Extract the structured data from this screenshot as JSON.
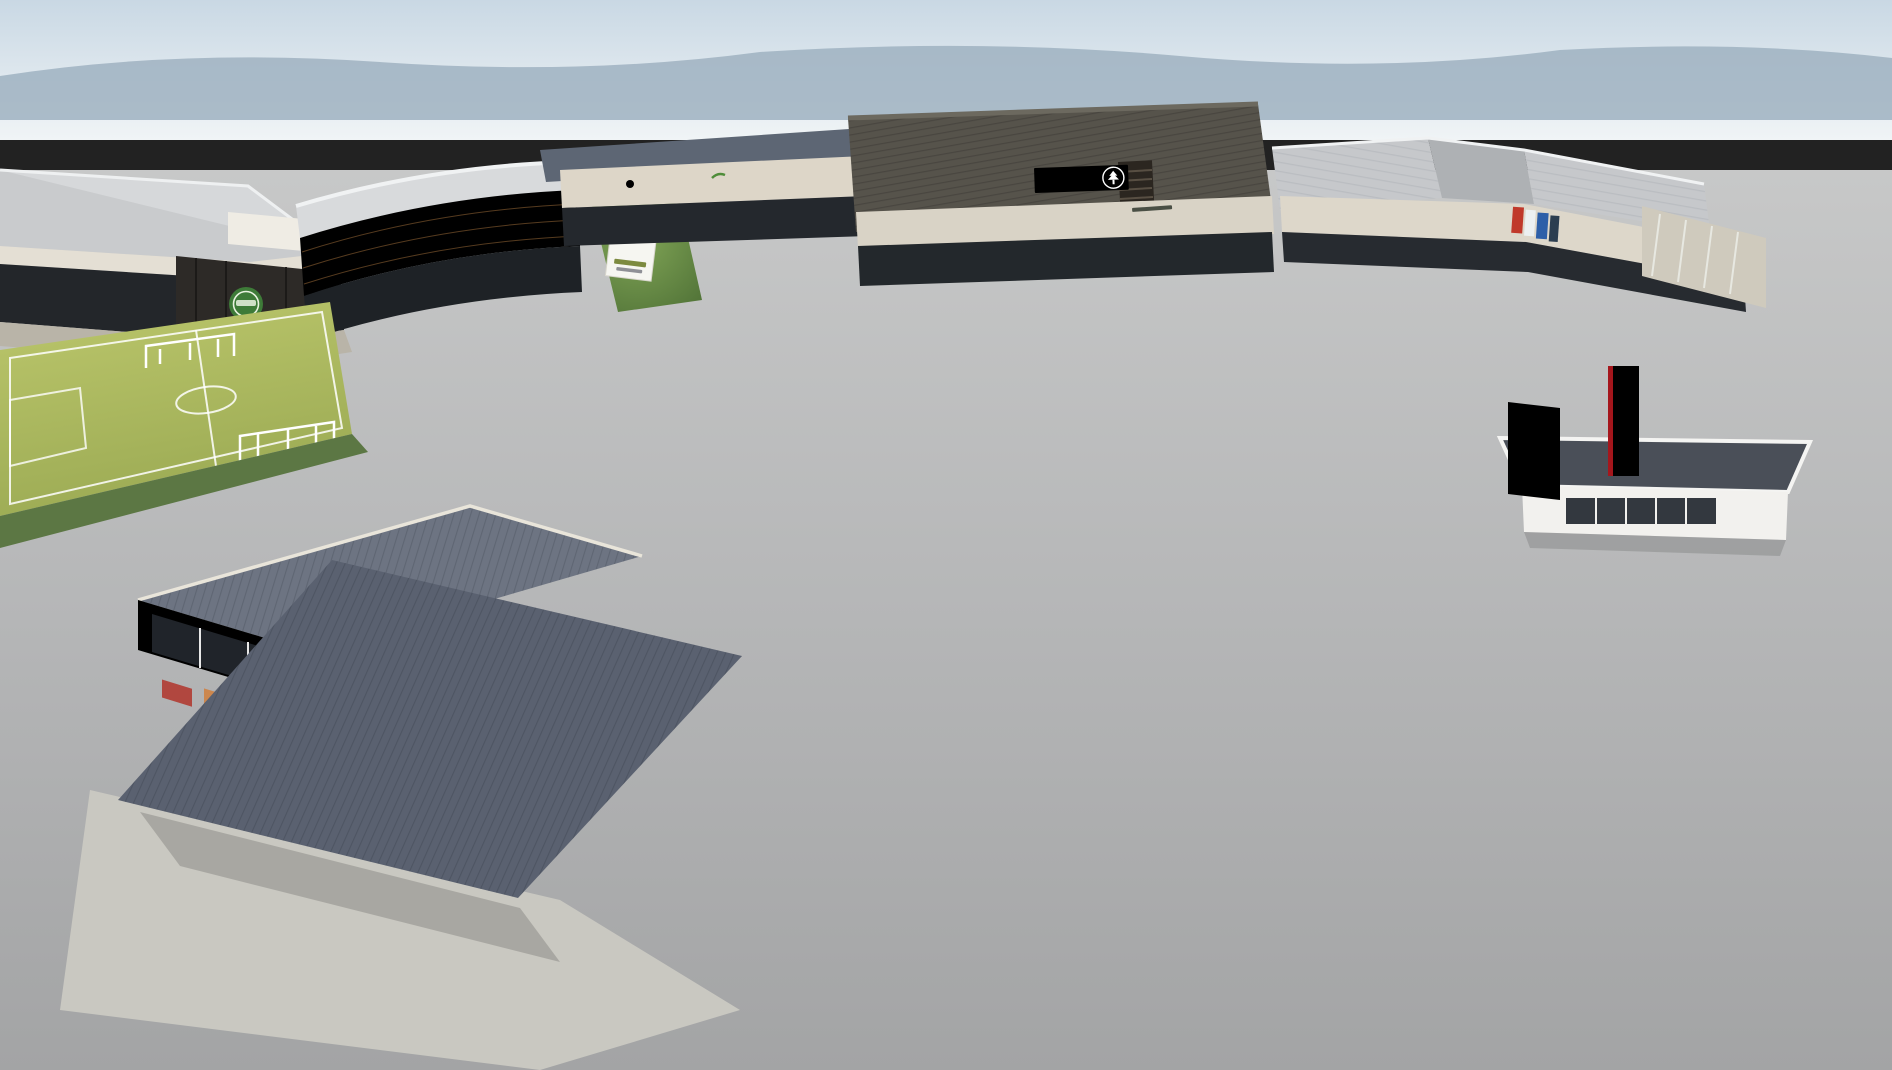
{
  "scene": {
    "type": "aerial-architectural-render",
    "subject": "retail centre with parking, petrol station, KFC drive-thru and soccer field"
  },
  "signs": {
    "market_line1": "The Market @",
    "market_line2": "GREENFIELDS",
    "jonahs": "JONAH'S",
    "mona_lisa": "Mona Lisa",
    "nutrive": "NUTRIVE",
    "sanagro": "Sanagro",
    "spar": "SPAR",
    "tops": "tops!",
    "kfc_pylon": "KFC",
    "kfc_fascia": "KFC"
  },
  "colors": {
    "spar_red": "#e2001a",
    "spar_green": "#00803d",
    "kfc_red": "#d21f26",
    "tops_red": "#e0362c",
    "lime_fascia": "#c6d830",
    "trim_red": "#e8402c",
    "agri_yellow": "#f2d900",
    "agri_green": "#2f7d33",
    "jonahs_purple": "#4a3f96",
    "mona_blue": "#2f6fae",
    "sign_green": "#57923c",
    "wood_fascia": "#b5854f"
  }
}
